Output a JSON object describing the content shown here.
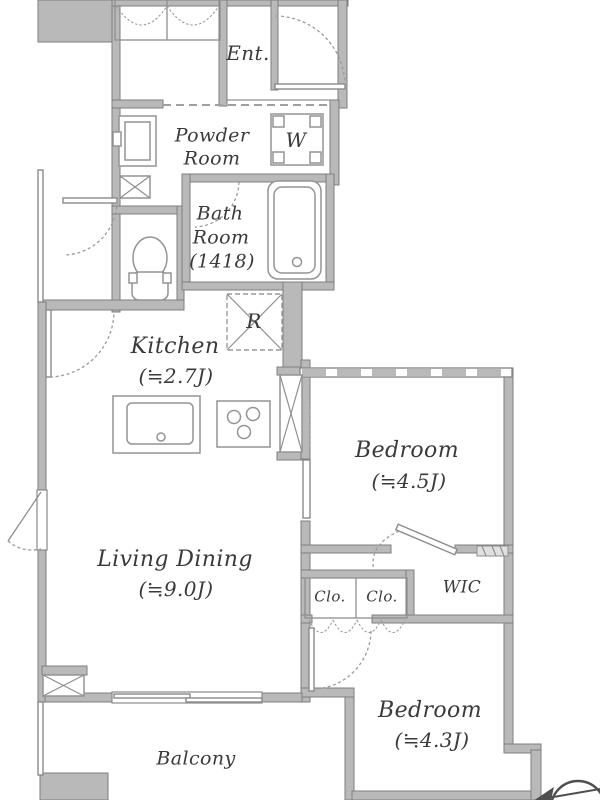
{
  "rooms": {
    "entrance": "Ent.",
    "powder": {
      "l1": "Powder",
      "l2": "Room"
    },
    "washer": "W",
    "bathroom": {
      "l1": "Bath",
      "l2": "Room",
      "l3": "(1418)"
    },
    "fridge": "R",
    "kitchen": {
      "name": "Kitchen",
      "size": "(≒2.7J)"
    },
    "bedroom_east": {
      "name": "Bedroom",
      "size": "(≒4.5J)"
    },
    "living_dining": {
      "name": "Living Dining",
      "size": "(≒9.0J)"
    },
    "closet_left": "Clo.",
    "closet_right": "Clo.",
    "wic": "WIC",
    "bedroom_south": {
      "name": "Bedroom",
      "size": "(≒4.3J)"
    },
    "balcony": "Balcony"
  },
  "colors": {
    "background": "#ffffff",
    "wall_fill": "#b9b9b9",
    "wall_edge": "#7e7e7e",
    "text": "#3a3a3a"
  }
}
